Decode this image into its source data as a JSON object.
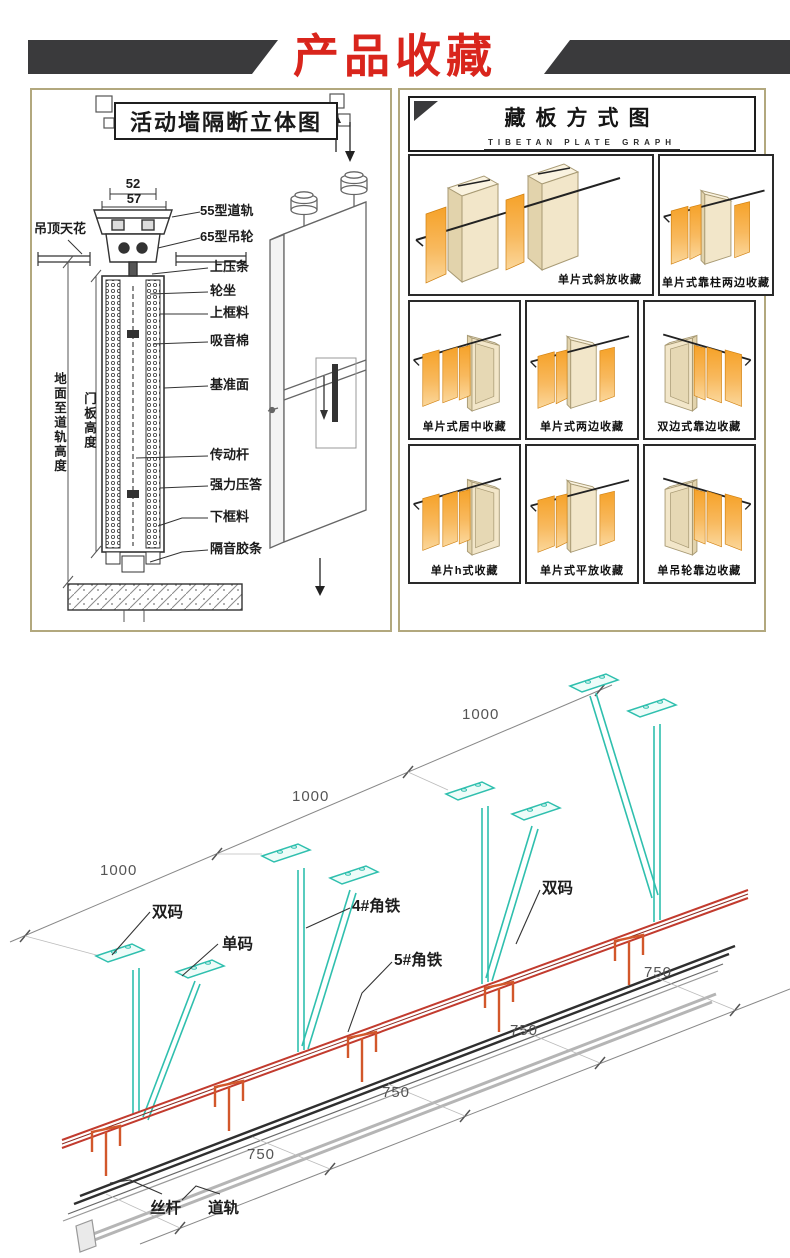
{
  "page": {
    "title": "产品收藏"
  },
  "colors": {
    "title_red": "#d9251c",
    "header_bar": "#3a3a3c",
    "panel_border": "#b2a87e",
    "support_teal": "#2fbfae",
    "track_red": "#c23b2e",
    "bracket_orange": "#d2572b",
    "panel_orange": "#f39c12",
    "frame_cream": "#f2e6c9"
  },
  "left_panel": {
    "title": "活动墙隔断立体图",
    "dim_52": "52",
    "dim_57": "57",
    "labels": {
      "ceiling": "吊顶天花",
      "rail55": "55型道轨",
      "wheel65": "65型吊轮",
      "top_strip": "上压条",
      "wheel_seat": "轮坐",
      "top_frame": "上框料",
      "acoustic_cotton": "吸音棉",
      "datum_face": "基准面",
      "drive_rod": "传动杆",
      "strong_seal": "强力压答",
      "bottom_frame": "下框料",
      "sound_strip": "隔音胶条",
      "height_floor_to_rail": "地面至道轨高度",
      "height_door": "门板高度"
    }
  },
  "right_panel": {
    "title": "藏板方式图",
    "subtitle": "TIBETAN PLATE GRAPH",
    "cells": [
      {
        "caption": "单片式斜放收藏"
      },
      {
        "caption": "单片式靠柱两边收藏"
      },
      {
        "caption": "单片式居中收藏"
      },
      {
        "caption": "单片式两边收藏"
      },
      {
        "caption": "双边式靠边收藏"
      },
      {
        "caption": "单片h式收藏"
      },
      {
        "caption": "单片式平放收藏"
      },
      {
        "caption": "单吊轮靠边收藏"
      }
    ]
  },
  "bottom": {
    "dims_1000": [
      "1000",
      "1000",
      "1000"
    ],
    "dims_750": [
      "750",
      "750",
      "750",
      "750"
    ],
    "labels": {
      "shuangma1": "双码",
      "danma": "单码",
      "angle4": "4#角铁",
      "angle5": "5#角铁",
      "shuangma2": "双码",
      "sigan": "丝杆",
      "daogui": "道轨"
    }
  }
}
